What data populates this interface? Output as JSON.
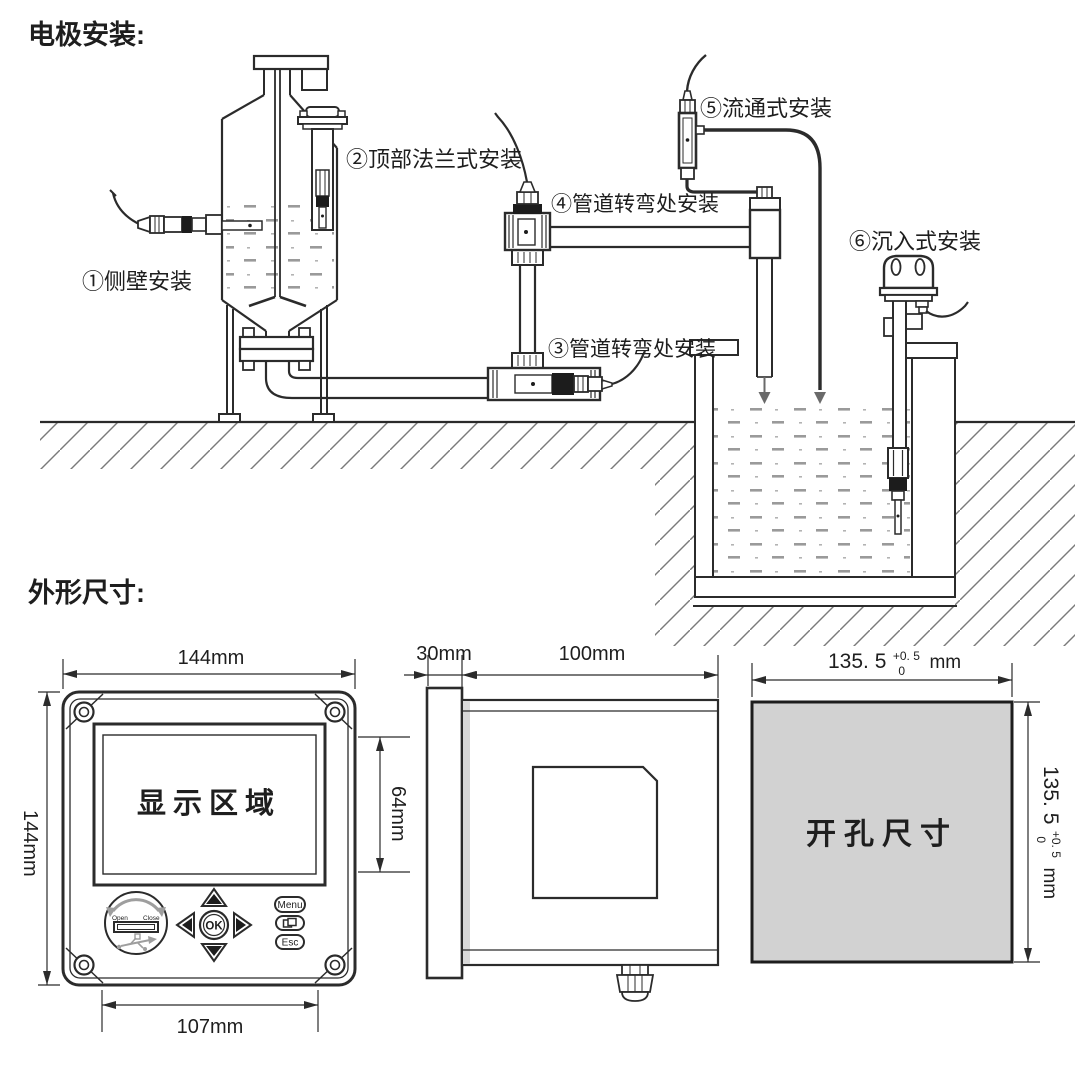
{
  "titles": {
    "electrode_install": "电极安装:",
    "outline_dims": "外形尺寸:"
  },
  "install_labels": {
    "side_wall": "①侧壁安装",
    "top_flange": "②顶部法兰式安装",
    "pipe_bend_lower": "③管道转弯处安装",
    "pipe_bend_upper": "④管道转弯处安装",
    "flow_through": "⑤流通式安装",
    "submersion": "⑥沉入式安装"
  },
  "front_view": {
    "width": "144mm",
    "height": "144mm",
    "display_area": "显示区域",
    "display_height": "64mm",
    "keypad_width": "107mm",
    "menu_button": "Menu",
    "ok_button": "OK",
    "esc_button": "Esc",
    "usb_open": "Open",
    "usb_close": "Close"
  },
  "side_view": {
    "bezel_depth": "30mm",
    "body_depth": "100mm"
  },
  "cutout_view": {
    "label": "开孔尺寸",
    "width": {
      "main": "135. 5",
      "tol_plus": "+0. 5",
      "tol_minus": "0",
      "unit": "mm"
    },
    "height": {
      "main": "135. 5",
      "tol_plus": "+0. 5",
      "tol_minus": "0",
      "unit": "mm"
    }
  },
  "colors": {
    "ink": "#2b2b2b",
    "cutout_fill": "#d2d2d2",
    "water_dash": "#9a9a9a",
    "ground_hatch": "#777777",
    "usb_gray": "#9e9e9e"
  }
}
